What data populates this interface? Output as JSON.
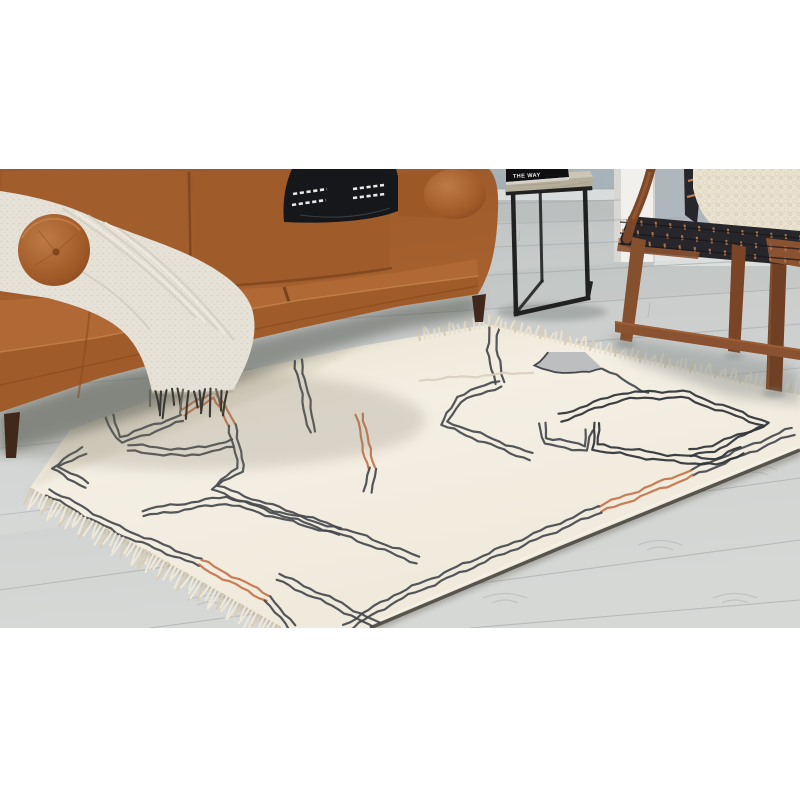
{
  "scene": {
    "alt": "Living room lifestyle photo: ivory area rug with abstract charcoal and rust line pattern and fringe, cognac leather sofa with cream boucle throw and black accent pillow, black metal side table with stone top and a book, and a wood accent chair with woven black leather straps and a chunky cream pillow, on gray wood plank flooring.",
    "book_title": "THE WAY"
  },
  "palette": {
    "wall": "#a5afb7",
    "wall_right": "#aeb7bd",
    "baseboard": "#e2e5e4",
    "column": "#f1f0ed",
    "floor": "#c9cccb",
    "floor_seam": "#a7abab",
    "rug": "#f3eee2",
    "fringe": "#efe8d7",
    "fringe_dark": "#d9cdb4",
    "line": "#45494d",
    "line_dark": "#2e3236",
    "accent": "#c3734a",
    "faint": "#d9cfbf",
    "patch": "#b7babd",
    "sofa": "#a5602e",
    "sofa_light": "#b26c37",
    "sofa_dark": "#8a4d22",
    "sofa_leg": "#40281a",
    "throw": "#e6e2d7",
    "tassel": "#3a3a34",
    "pillow_black": "#15171b",
    "stitch": "#e9e9e7",
    "table_frame": "#212121",
    "table_top": "#c6c0ae",
    "book": "#0f0f11",
    "book_text": "#e8e8e6",
    "wood": "#8a5231",
    "wood_dark": "#6f4023",
    "strap": "#26262b",
    "strap_gap": "#bd7c4e",
    "chair_pillow": "#eae2d1"
  },
  "rug_pattern": {
    "patch": [
      [
        535,
        366
      ],
      [
        548,
        352
      ],
      [
        585,
        352
      ],
      [
        603,
        369
      ],
      [
        562,
        374
      ]
    ],
    "paths": [
      {
        "c": "line",
        "pts": [
          [
            100,
            385
          ],
          [
            104,
            404
          ],
          [
            112,
            424
          ],
          [
            121,
            440
          ],
          [
            182,
            418
          ]
        ]
      },
      {
        "c": "accent",
        "pts": [
          [
            183,
            413
          ],
          [
            214,
            394
          ],
          [
            232,
            425
          ]
        ]
      },
      {
        "c": "line",
        "pts": [
          [
            232,
            425
          ],
          [
            238,
            452
          ],
          [
            240,
            470
          ],
          [
            214,
            487
          ],
          [
            258,
            504
          ],
          [
            352,
            535
          ],
          [
            418,
            560
          ]
        ]
      },
      {
        "c": "line",
        "pts": [
          [
            143,
            513
          ],
          [
            226,
            500
          ],
          [
            340,
            532
          ]
        ]
      },
      {
        "c": "line",
        "pts": [
          [
            84,
            450
          ],
          [
            55,
            468
          ],
          [
            87,
            485
          ]
        ]
      },
      {
        "c": "line",
        "pts": [
          [
            48,
            492
          ],
          [
            118,
            530
          ],
          [
            200,
            563
          ]
        ]
      },
      {
        "c": "accent",
        "pts": [
          [
            200,
            563
          ],
          [
            268,
            598
          ]
        ]
      },
      {
        "c": "line",
        "pts": [
          [
            268,
            598
          ],
          [
            292,
            628
          ]
        ]
      },
      {
        "c": "line",
        "pts": [
          [
            278,
            577
          ],
          [
            340,
            606
          ],
          [
            384,
            630
          ]
        ]
      },
      {
        "c": "line",
        "pts": [
          [
            793,
            431
          ],
          [
            692,
            473
          ]
        ]
      },
      {
        "c": "accent",
        "pts": [
          [
            692,
            473
          ],
          [
            600,
            509
          ]
        ]
      },
      {
        "c": "line",
        "pts": [
          [
            600,
            509
          ],
          [
            490,
            556
          ],
          [
            395,
            598
          ],
          [
            345,
            628
          ]
        ]
      },
      {
        "c": "line",
        "gap": 9,
        "pts": [
          [
            495,
            328
          ],
          [
            491,
            350
          ],
          [
            497,
            368
          ],
          [
            500,
            383
          ]
        ]
      },
      {
        "c": "line",
        "pts": [
          [
            500,
            383
          ],
          [
            459,
            399
          ],
          [
            444,
            423
          ],
          [
            492,
            442
          ],
          [
            531,
            457
          ]
        ]
      },
      {
        "c": "line",
        "pts": [
          [
            543,
            423
          ],
          [
            545,
            441
          ],
          [
            586,
            448
          ],
          [
            589,
            430
          ]
        ]
      },
      {
        "c": "line",
        "single": true,
        "pts": [
          [
            603,
            369
          ],
          [
            648,
            393
          ]
        ]
      },
      {
        "c": "dark",
        "pts": [
          [
            560,
            418
          ],
          [
            622,
            396
          ],
          [
            682,
            394
          ],
          [
            766,
            424
          ],
          [
            713,
            448
          ],
          [
            690,
            453
          ]
        ]
      },
      {
        "c": "dark",
        "pts": [
          [
            597,
            423
          ],
          [
            595,
            447
          ],
          [
            660,
            457
          ],
          [
            716,
            462
          ],
          [
            742,
            450
          ]
        ]
      },
      {
        "c": "line",
        "pts": [
          [
            297,
            355
          ],
          [
            303,
            386
          ],
          [
            309,
            416
          ],
          [
            313,
            432
          ]
        ]
      },
      {
        "c": "accent",
        "pts": [
          [
            360,
            414
          ],
          [
            365,
            444
          ],
          [
            372,
            468
          ]
        ]
      },
      {
        "c": "line",
        "pts": [
          [
            372,
            468
          ],
          [
            368,
            492
          ]
        ]
      },
      {
        "c": "faint",
        "single": true,
        "pts": [
          [
            420,
            380
          ],
          [
            533,
            372
          ]
        ]
      },
      {
        "c": "line",
        "pts": [
          [
            128,
            448
          ],
          [
            185,
            453
          ],
          [
            233,
            444
          ]
        ]
      }
    ]
  }
}
